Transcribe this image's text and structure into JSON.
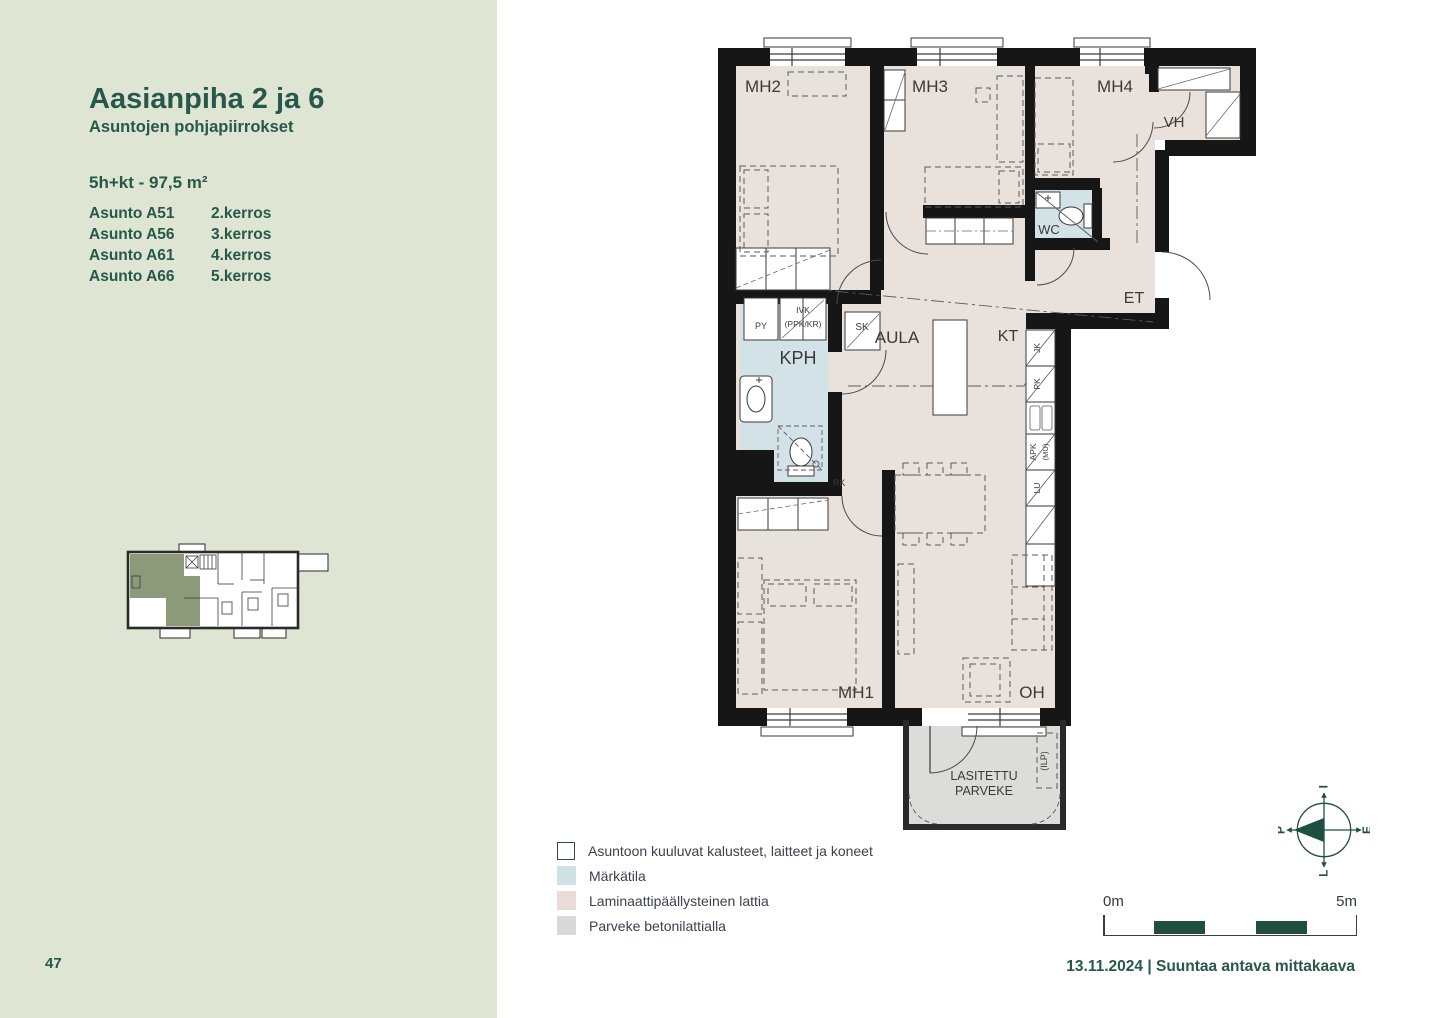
{
  "sidebar": {
    "title": "Aasianpiha 2 ja 6",
    "subtitle": "Asuntojen pohjapiirrokset",
    "apartment_type": "5h+kt - 97,5 m²",
    "apartments": [
      {
        "name": "Asunto A51",
        "floor": "2.kerros"
      },
      {
        "name": "Asunto A56",
        "floor": "3.kerros"
      },
      {
        "name": "Asunto A61",
        "floor": "4.kerros"
      },
      {
        "name": "Asunto A66",
        "floor": "5.kerros"
      }
    ]
  },
  "floorplan": {
    "rooms": {
      "mh2": "MH2",
      "mh3": "MH3",
      "mh4": "MH4",
      "vh": "VH",
      "wc": "WC",
      "et": "ET",
      "aula": "AULA",
      "kt": "KT",
      "kph": "KPH",
      "mh1": "MH1",
      "oh": "OH"
    },
    "balcony": {
      "line1": "LASITETTU",
      "line2": "PARVEKE",
      "ilp": "(ILP)"
    },
    "fixtures": {
      "py": "PY",
      "ivk": "IVK",
      "ppk_kr": "(PPK/KR)",
      "sk": "SK",
      "rk": "RK",
      "jk": "JK",
      "pk": "PK",
      "apk": "APK",
      "mu": "(MU)",
      "lu": "LU"
    }
  },
  "legend": {
    "items": [
      {
        "label": "Asuntoon kuuluvat kalusteet, laitteet ja koneet",
        "swatch": "#ffffff"
      },
      {
        "label": "Märkätila",
        "swatch": "#cfe1e5"
      },
      {
        "label": "Laminaattipäällysteinen lattia",
        "swatch": "#eadbd6"
      },
      {
        "label": "Parveke betonilattialla",
        "swatch": "#d9dad7"
      }
    ]
  },
  "scalebar": {
    "start": "0m",
    "end": "5m"
  },
  "compass": {
    "top": "I",
    "right": "E",
    "bottom": "L",
    "left": "P"
  },
  "footer": {
    "page_number": "47",
    "date": "13.11.2024",
    "separator": "|",
    "note": "Suuntaa antava mittakaava"
  },
  "colors": {
    "accent": "#27584a",
    "scalebar_fill": "#1e4f41",
    "sidebar_bg": "#dee5d2",
    "wall": "#161616",
    "floor": "#e9e1dc",
    "wet": "#d2e2e6",
    "balcony_floor": "#dcdcda",
    "keyplan_highlight": "#8c9a79"
  }
}
